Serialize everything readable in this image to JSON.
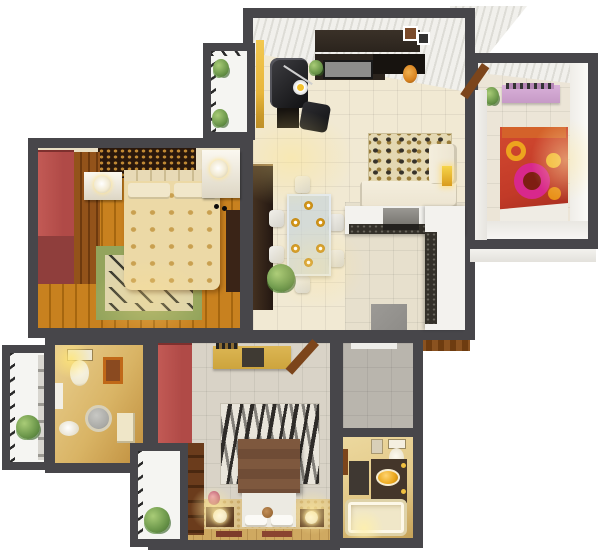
{
  "scene": {
    "name": "3d-apartment-floor-plan-render",
    "view": "top-down-3d",
    "background": "#ffffff"
  },
  "palette": {
    "wall": "#47464a",
    "livingFloor": "#f1e9d3",
    "kitchenFloor": "#e7e0cd",
    "ceilingStripeA": "#f1f0ec",
    "ceilingStripeB": "#dddcd6",
    "yellowScreen": "#e8b63c",
    "darkFurniture": "#2b241d",
    "blackFurniture": "#17130f",
    "tvScreen": "#8e8e8c",
    "leopardBase": "#e4d8b2",
    "sofaCream": "#ece4d0",
    "accentYellow": "#f2c12e",
    "glassTable": "#c3d2da",
    "plateGold": "#d99b1c",
    "woodFloorA": "#c8811f",
    "woodFloorB": "#a5660f",
    "creamCeiling": "#e9dfc4",
    "headboardDark": "#2a180c",
    "headboardGold": "#c18a34",
    "bedCover": "#ecd9a6",
    "bedPattern": "#c9a050",
    "pillowCream": "#f1e7ca",
    "redWardrobe": "#b04a47",
    "maroon": "#8f3e3c",
    "woodCloset": "#8a4a14",
    "rugOlive": "#93a45c",
    "rugCenter": "#ddd4ad",
    "dresserDark": "#3a2417",
    "kidsFloor": "#ece5d7",
    "kidsBedRed": "#c23a28",
    "kidsRingPink": "#d8288c",
    "kidsCircleYellow": "#eda41e",
    "kidsPillowOrange": "#d4622a",
    "pinkShelf": "#c79ac7",
    "bath1Gold": "#d9b465",
    "bath1Deep": "#c08f3e",
    "toiletCream": "#efe9d2",
    "mirrorGray": "#a8a8a4",
    "pictureOrange": "#c06818",
    "bed2Tile": "#d9d3c7",
    "bed2Carpet": "#dcc48e",
    "carpetSpeckle": "#c9a968",
    "zebraLight": "#e9e5db",
    "zebraDark": "#2e2b28",
    "bed2Brown": "#6f4c36",
    "sheetWhite": "#eceae2",
    "deskMustard": "#cda43d",
    "nightstandWood": "#5c3a20",
    "matRed": "#7e3b2a",
    "utilTile": "#b9b5ad",
    "bath2Floor": "#e2c887",
    "tubCream": "#f0e7c8",
    "vanityDark": "#44362a",
    "sinkGold": "#eaa71c",
    "counterWhite": "#f3f2ee",
    "graniteDark": "#34312a",
    "applianceGray": "#8e8c88",
    "balconyWhite": "#f5f5f2",
    "tickDark": "#2a2a2a",
    "plantGreen": "#6f9a4d",
    "plantDeep": "#4a7434",
    "doorBrown": "#7c451b",
    "entryWood": "#8a5220",
    "wallFaceLight": "#f3f2ee"
  },
  "rooms": [
    {
      "id": "living-dining",
      "label": "living-dining-area",
      "furniture": [
        "tv-console",
        "tv-screen",
        "picture-frames",
        "armchair",
        "arc-lamp",
        "side-table",
        "ottoman",
        "leopard-rug",
        "corner-sofa",
        "sofa-lamp",
        "wall-cabinet",
        "dining-table",
        "dining-chairs-x6",
        "gold-plates-x6",
        "palm-plant",
        "yellow-screen"
      ]
    },
    {
      "id": "kitchen",
      "label": "open-kitchen",
      "furniture": [
        "l-shaped-counter",
        "granite-countertop",
        "stove",
        "refrigerator"
      ]
    },
    {
      "id": "kids-bedroom",
      "label": "kids-bedroom",
      "furniture": [
        "bed-red-circle-pattern",
        "pink-dresser",
        "books",
        "plant",
        "open-door"
      ]
    },
    {
      "id": "master-bedroom",
      "label": "master-bedroom",
      "furniture": [
        "double-bed-gold-bedding",
        "carved-headboard-panel",
        "nightstand-left",
        "nightstand-right",
        "table-lamps",
        "red-wardrobe",
        "wood-closet",
        "green-rug",
        "dresser"
      ]
    },
    {
      "id": "bathroom-1",
      "label": "bathroom",
      "furniture": [
        "toilet",
        "round-mirror",
        "sink",
        "picture-frame",
        "cabinet"
      ]
    },
    {
      "id": "second-bedroom",
      "label": "second-bedroom",
      "furniture": [
        "bed-brown-white",
        "zebra-rug",
        "red-wardrobe",
        "shelf-unit",
        "tv-desk",
        "nightstand-left",
        "nightstand-right",
        "floor-mats",
        "flower-vase",
        "open-door"
      ]
    },
    {
      "id": "utility",
      "label": "utility-area",
      "furniture": []
    },
    {
      "id": "bathroom-2",
      "label": "bathroom",
      "furniture": [
        "toilet",
        "vanity-gold-sink",
        "bathtub",
        "bath-mat"
      ]
    },
    {
      "id": "balcony-top-left",
      "label": "balcony",
      "furniture": [
        "plant",
        "plant"
      ]
    },
    {
      "id": "balcony-left",
      "label": "balcony",
      "furniture": [
        "plant"
      ]
    },
    {
      "id": "balcony-bottom-left",
      "label": "balcony",
      "furniture": [
        "plant"
      ]
    },
    {
      "id": "entry",
      "label": "entry-threshold",
      "furniture": []
    }
  ]
}
